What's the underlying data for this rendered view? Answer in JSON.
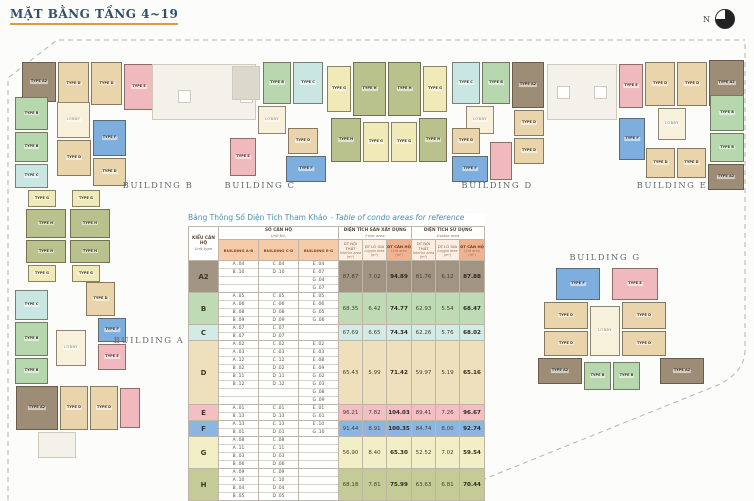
{
  "page": {
    "title": "MẶT BẰNG TẦNG 4~19",
    "compass_label": "N"
  },
  "buildings": {
    "strip": [
      "BUILDING B",
      "BUILDING C",
      "BUILDING D",
      "BUILDING E"
    ],
    "a": "BUILDING A",
    "g": "BUILDING G"
  },
  "plan": {
    "type_label_prefix": "TYPE",
    "lobby_label": "LOBBY",
    "colors": {
      "A2": "#9d8d77",
      "B": "#b7d7af",
      "C": "#c9e6e2",
      "D": "#e9d4ab",
      "E": "#f0b9be",
      "F": "#7eaede",
      "G": "#efeab8",
      "H": "#b9c18c",
      "LOBBY": "#f7f0da",
      "ROOF": "#f3f1ea",
      "SQ": "#ffffff",
      "PALE": "#f3f1ea",
      "SVC": "#ddd8cc"
    },
    "blocks": [
      {
        "t": "A2",
        "x": 22,
        "y": 62,
        "w": 34,
        "h": 40,
        "l": 1
      },
      {
        "t": "D",
        "x": 58,
        "y": 62,
        "w": 31,
        "h": 43,
        "l": 1
      },
      {
        "t": "D",
        "x": 91,
        "y": 62,
        "w": 31,
        "h": 43,
        "l": 1
      },
      {
        "t": "E",
        "x": 124,
        "y": 64,
        "w": 30,
        "h": 46,
        "l": 1
      },
      {
        "t": "B",
        "x": 15,
        "y": 97,
        "w": 33,
        "h": 33,
        "l": 1
      },
      {
        "t": "B",
        "x": 15,
        "y": 132,
        "w": 33,
        "h": 30,
        "l": 1
      },
      {
        "t": "C",
        "x": 15,
        "y": 164,
        "w": 33,
        "h": 24,
        "l": 1
      },
      {
        "t": "LOBBY",
        "x": 57,
        "y": 102,
        "w": 33,
        "h": 36,
        "l": 1
      },
      {
        "t": "F",
        "x": 93,
        "y": 120,
        "w": 33,
        "h": 36,
        "l": 1
      },
      {
        "t": "D",
        "x": 57,
        "y": 140,
        "w": 34,
        "h": 36,
        "l": 1
      },
      {
        "t": "D",
        "x": 93,
        "y": 158,
        "w": 33,
        "h": 28,
        "l": 1
      },
      {
        "t": "ROOF",
        "x": 152,
        "y": 64,
        "w": 104,
        "h": 56
      },
      {
        "t": "SQ",
        "x": 178,
        "y": 90,
        "w": 13,
        "h": 13
      },
      {
        "t": "SQ",
        "x": 240,
        "y": 90,
        "w": 13,
        "h": 13
      },
      {
        "t": "SVC",
        "x": 232,
        "y": 66,
        "w": 28,
        "h": 34
      },
      {
        "t": "B",
        "x": 263,
        "y": 62,
        "w": 28,
        "h": 42,
        "l": 1
      },
      {
        "t": "C",
        "x": 293,
        "y": 62,
        "w": 30,
        "h": 42,
        "l": 1
      },
      {
        "t": "LOBBY",
        "x": 258,
        "y": 106,
        "w": 28,
        "h": 28,
        "l": 1
      },
      {
        "t": "E",
        "x": 230,
        "y": 138,
        "w": 26,
        "h": 38,
        "l": 1
      },
      {
        "t": "D",
        "x": 288,
        "y": 128,
        "w": 30,
        "h": 26,
        "l": 1
      },
      {
        "t": "F",
        "x": 286,
        "y": 156,
        "w": 40,
        "h": 26,
        "l": 1
      },
      {
        "t": "G",
        "x": 327,
        "y": 66,
        "w": 24,
        "h": 46,
        "l": 1
      },
      {
        "t": "H",
        "x": 353,
        "y": 62,
        "w": 33,
        "h": 54,
        "l": 1
      },
      {
        "t": "H",
        "x": 388,
        "y": 62,
        "w": 33,
        "h": 54,
        "l": 1
      },
      {
        "t": "G",
        "x": 423,
        "y": 66,
        "w": 24,
        "h": 46,
        "l": 1
      },
      {
        "t": "H",
        "x": 331,
        "y": 118,
        "w": 30,
        "h": 44,
        "l": 1
      },
      {
        "t": "G",
        "x": 363,
        "y": 122,
        "w": 26,
        "h": 40,
        "l": 1
      },
      {
        "t": "G",
        "x": 391,
        "y": 122,
        "w": 26,
        "h": 40,
        "l": 1
      },
      {
        "t": "H",
        "x": 419,
        "y": 118,
        "w": 28,
        "h": 44,
        "l": 1
      },
      {
        "t": "C",
        "x": 452,
        "y": 62,
        "w": 28,
        "h": 42,
        "l": 1
      },
      {
        "t": "B",
        "x": 482,
        "y": 62,
        "w": 28,
        "h": 42,
        "l": 1
      },
      {
        "t": "A2",
        "x": 512,
        "y": 62,
        "w": 32,
        "h": 46,
        "l": 1
      },
      {
        "t": "LOBBY",
        "x": 466,
        "y": 106,
        "w": 28,
        "h": 28,
        "l": 1
      },
      {
        "t": "D",
        "x": 452,
        "y": 128,
        "w": 28,
        "h": 26,
        "l": 1
      },
      {
        "t": "F",
        "x": 452,
        "y": 156,
        "w": 36,
        "h": 26,
        "l": 1
      },
      {
        "t": "E",
        "x": 490,
        "y": 142,
        "w": 22,
        "h": 38
      },
      {
        "t": "D",
        "x": 514,
        "y": 110,
        "w": 30,
        "h": 26,
        "l": 1
      },
      {
        "t": "D",
        "x": 514,
        "y": 138,
        "w": 30,
        "h": 26,
        "l": 1
      },
      {
        "t": "ROOF",
        "x": 547,
        "y": 64,
        "w": 70,
        "h": 56
      },
      {
        "t": "SQ",
        "x": 557,
        "y": 86,
        "w": 13,
        "h": 13
      },
      {
        "t": "SQ",
        "x": 594,
        "y": 86,
        "w": 13,
        "h": 13
      },
      {
        "t": "E",
        "x": 619,
        "y": 64,
        "w": 24,
        "h": 44,
        "l": 1
      },
      {
        "t": "D",
        "x": 645,
        "y": 62,
        "w": 30,
        "h": 44,
        "l": 1
      },
      {
        "t": "D",
        "x": 677,
        "y": 62,
        "w": 30,
        "h": 44,
        "l": 1
      },
      {
        "t": "A2",
        "x": 709,
        "y": 60,
        "w": 35,
        "h": 46,
        "l": 1
      },
      {
        "t": "F",
        "x": 619,
        "y": 118,
        "w": 26,
        "h": 42,
        "l": 1
      },
      {
        "t": "LOBBY",
        "x": 658,
        "y": 108,
        "w": 28,
        "h": 32,
        "l": 1
      },
      {
        "t": "B",
        "x": 710,
        "y": 95,
        "w": 34,
        "h": 36,
        "l": 1
      },
      {
        "t": "B",
        "x": 710,
        "y": 133,
        "w": 34,
        "h": 29,
        "l": 1
      },
      {
        "t": "A2",
        "x": 708,
        "y": 164,
        "w": 36,
        "h": 26,
        "l": 1
      },
      {
        "t": "D",
        "x": 646,
        "y": 148,
        "w": 29,
        "h": 30,
        "l": 1
      },
      {
        "t": "D",
        "x": 677,
        "y": 148,
        "w": 29,
        "h": 30,
        "l": 1
      },
      {
        "t": "G",
        "x": 28,
        "y": 190,
        "w": 28,
        "h": 17,
        "l": 1
      },
      {
        "t": "G",
        "x": 72,
        "y": 190,
        "w": 28,
        "h": 17,
        "l": 1
      },
      {
        "t": "H",
        "x": 26,
        "y": 209,
        "w": 40,
        "h": 29,
        "l": 1
      },
      {
        "t": "H",
        "x": 70,
        "y": 209,
        "w": 40,
        "h": 29,
        "l": 1
      },
      {
        "t": "H",
        "x": 26,
        "y": 240,
        "w": 40,
        "h": 23,
        "l": 1
      },
      {
        "t": "H",
        "x": 70,
        "y": 240,
        "w": 40,
        "h": 23,
        "l": 1
      },
      {
        "t": "G",
        "x": 28,
        "y": 265,
        "w": 28,
        "h": 17,
        "l": 1
      },
      {
        "t": "G",
        "x": 72,
        "y": 265,
        "w": 28,
        "h": 17,
        "l": 1
      },
      {
        "t": "C",
        "x": 15,
        "y": 290,
        "w": 33,
        "h": 30,
        "l": 1
      },
      {
        "t": "B",
        "x": 15,
        "y": 322,
        "w": 33,
        "h": 34,
        "l": 1
      },
      {
        "t": "B",
        "x": 15,
        "y": 358,
        "w": 33,
        "h": 26,
        "l": 1
      },
      {
        "t": "D",
        "x": 86,
        "y": 282,
        "w": 29,
        "h": 34,
        "l": 1
      },
      {
        "t": "F",
        "x": 98,
        "y": 318,
        "w": 28,
        "h": 24,
        "l": 1
      },
      {
        "t": "LOBBY",
        "x": 56,
        "y": 330,
        "w": 30,
        "h": 36,
        "l": 1
      },
      {
        "t": "E",
        "x": 98,
        "y": 344,
        "w": 28,
        "h": 26,
        "l": 1
      },
      {
        "t": "A2",
        "x": 16,
        "y": 386,
        "w": 42,
        "h": 44,
        "l": 1
      },
      {
        "t": "D",
        "x": 60,
        "y": 386,
        "w": 28,
        "h": 44,
        "l": 1
      },
      {
        "t": "D",
        "x": 90,
        "y": 386,
        "w": 28,
        "h": 44,
        "l": 1
      },
      {
        "t": "E",
        "x": 120,
        "y": 388,
        "w": 20,
        "h": 40
      },
      {
        "t": "PALE",
        "x": 38,
        "y": 432,
        "w": 38,
        "h": 26
      },
      {
        "t": "F",
        "x": 556,
        "y": 268,
        "w": 44,
        "h": 32,
        "l": 1
      },
      {
        "t": "E",
        "x": 612,
        "y": 268,
        "w": 46,
        "h": 32,
        "l": 1
      },
      {
        "t": "D",
        "x": 544,
        "y": 302,
        "w": 44,
        "h": 27,
        "l": 1
      },
      {
        "t": "D",
        "x": 544,
        "y": 331,
        "w": 44,
        "h": 25,
        "l": 1
      },
      {
        "t": "D",
        "x": 622,
        "y": 302,
        "w": 44,
        "h": 27,
        "l": 1
      },
      {
        "t": "D",
        "x": 622,
        "y": 331,
        "w": 44,
        "h": 25,
        "l": 1
      },
      {
        "t": "LOBBY",
        "x": 590,
        "y": 306,
        "w": 30,
        "h": 50,
        "l": 1
      },
      {
        "t": "A2",
        "x": 538,
        "y": 358,
        "w": 44,
        "h": 26,
        "l": 1
      },
      {
        "t": "B",
        "x": 584,
        "y": 362,
        "w": 27,
        "h": 28,
        "l": 1
      },
      {
        "t": "B",
        "x": 613,
        "y": 362,
        "w": 27,
        "h": 28,
        "l": 1
      },
      {
        "t": "A2",
        "x": 660,
        "y": 358,
        "w": 44,
        "h": 26,
        "l": 1
      }
    ]
  },
  "table": {
    "caption": {
      "vn": "Bảng Thông Số Diện Tích Tham Khảo",
      "en": "- Table of condo areas for reference"
    },
    "header": {
      "unit_type": {
        "vn": "KIỂU CĂN HỘ",
        "en": "Unit type"
      },
      "unit_no": {
        "vn": "SỐ CĂN HỘ",
        "en": "Unit No."
      },
      "floor_area": {
        "vn": "DIỆN TÍCH SÀN XÂY DỰNG",
        "en": "Floor area"
      },
      "usable_area": {
        "vn": "DIỆN TÍCH SỬ DỤNG",
        "en": "Usable area"
      },
      "buildings": [
        "BUILDING A-B",
        "BUILDING C-D",
        "BUILDING E-G"
      ],
      "sub": [
        {
          "vn": "DT NỘI THẤT",
          "en": "Interior area",
          "unit": "(m²)"
        },
        {
          "vn": "DT LÔ GIA",
          "en": "Loggia area",
          "unit": "(m²)"
        },
        {
          "vn": "DT CĂN HỘ",
          "en": "Unit area",
          "unit": "(m²)"
        }
      ]
    },
    "rows": [
      {
        "type": "A2",
        "color": "#a29482",
        "units_ab": [
          "A .04",
          "B .10"
        ],
        "units_cd": [
          "C .04",
          "D .10"
        ],
        "units_eg": [
          "E .04",
          "E .07",
          "G .04",
          "G .07"
        ],
        "floor": [
          "87.87",
          "7.02",
          "94.89"
        ],
        "usable": [
          "81.76",
          "6.12",
          "87.88"
        ]
      },
      {
        "type": "B",
        "color": "#bedbb5",
        "units_ab": [
          "A .05",
          "A .06",
          "B .08",
          "B .09"
        ],
        "units_cd": [
          "C .05",
          "C .06",
          "D .08",
          "D .09"
        ],
        "units_eg": [
          "E .05",
          "E .06",
          "G .05",
          "G .06"
        ],
        "floor": [
          "68.35",
          "6.42",
          "74.77"
        ],
        "usable": [
          "62.93",
          "5.54",
          "68.47"
        ]
      },
      {
        "type": "C",
        "color": "#d2ebe7",
        "units_ab": [
          "A .07",
          "B .07"
        ],
        "units_cd": [
          "C .07",
          "D .07"
        ],
        "units_eg": [],
        "floor": [
          "67.69",
          "6.65",
          "74.34"
        ],
        "usable": [
          "62.26",
          "5.76",
          "68.02"
        ]
      },
      {
        "type": "D",
        "color": "#eedfbd",
        "units_ab": [
          "A .02",
          "A .03",
          "A .12",
          "B .02",
          "B .11",
          "B .12"
        ],
        "units_cd": [
          "C .02",
          "C .03",
          "C .12",
          "D .02",
          "D .11",
          "D .12"
        ],
        "units_eg": [
          "E .02",
          "E .03",
          "E .08",
          "E .09",
          "G .02",
          "G .03",
          "G .08",
          "G .09"
        ],
        "floor": [
          "65.43",
          "5.99",
          "71.42"
        ],
        "usable": [
          "59.97",
          "5.19",
          "65.16"
        ]
      },
      {
        "type": "E",
        "color": "#f4bfc3",
        "units_ab": [
          "A .01",
          "B .13"
        ],
        "units_cd": [
          "C .01",
          "D .13"
        ],
        "units_eg": [
          "E .01",
          "G .01"
        ],
        "floor": [
          "96.21",
          "7.82",
          "104.03"
        ],
        "usable": [
          "89.41",
          "7.26",
          "96.67"
        ]
      },
      {
        "type": "F",
        "color": "#8cb6e2",
        "units_ab": [
          "A .13",
          "B .01"
        ],
        "units_cd": [
          "C .13",
          "D .01"
        ],
        "units_eg": [
          "E .10",
          "G .10"
        ],
        "floor": [
          "91.44",
          "8.91",
          "100.35"
        ],
        "usable": [
          "84.74",
          "8.00",
          "92.74"
        ]
      },
      {
        "type": "G",
        "color": "#f2eec5",
        "units_ab": [
          "A .08",
          "A .11",
          "B .03",
          "B .06"
        ],
        "units_cd": [
          "C .08",
          "C .11",
          "D .03",
          "D .06"
        ],
        "units_eg": [],
        "floor": [
          "56.90",
          "8.40",
          "65.30"
        ],
        "usable": [
          "52.52",
          "7.02",
          "59.54"
        ]
      },
      {
        "type": "H",
        "color": "#c5cb96",
        "units_ab": [
          "A .09",
          "A .10",
          "B .04",
          "B .05"
        ],
        "units_cd": [
          "C .09",
          "C .10",
          "D .04",
          "D .05"
        ],
        "units_eg": [],
        "floor": [
          "68.18",
          "7.81",
          "75.99"
        ],
        "usable": [
          "63.63",
          "6.81",
          "70.44"
        ]
      }
    ]
  }
}
